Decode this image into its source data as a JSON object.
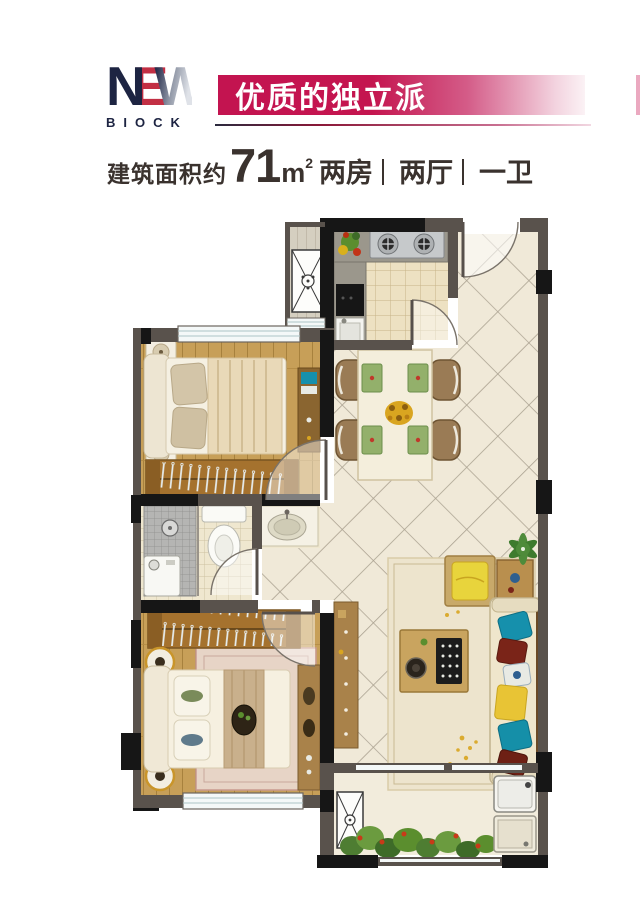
{
  "logo": {
    "letters": [
      "N",
      "E",
      "W"
    ],
    "subtitle": "BIOCK"
  },
  "banner": {
    "title": "优质的独立派"
  },
  "spec": {
    "area_prefix": "建筑面积约",
    "area_value": "71",
    "area_unit": "m",
    "area_unit_sup": "2",
    "layout": [
      "两房",
      "两厅",
      "一卫"
    ]
  },
  "colors": {
    "banner_pink": "#C31450",
    "logo_navy": "#1D2442",
    "logo_red": "#C22F44",
    "text_dark": "#3A322E",
    "wall_gray": "#59524C",
    "wall_black": "#161616",
    "wood_floor": "#C79F58",
    "tile_cream": "#F0E9D8",
    "sofa_cream": "#EFE6CC",
    "accent_teal": "#1690AC",
    "accent_yellow": "#E8C435"
  }
}
